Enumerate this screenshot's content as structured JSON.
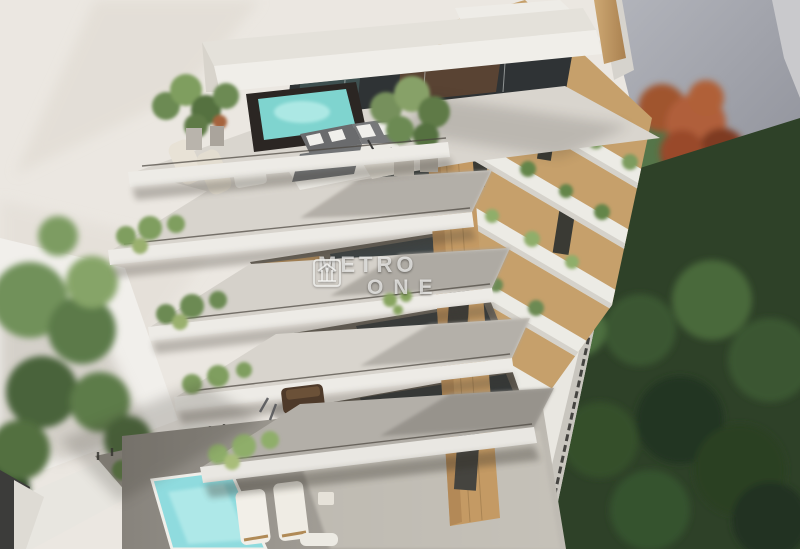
{
  "scene": {
    "type": "architectural-3d-render",
    "description": "Aerial visualization of a modern multi-storey residential building with rotated cantilevered terraces, rooftop jacuzzi terrace, garden pools and surrounding trees",
    "watermark": {
      "line1": "METRO",
      "line2": "ONE",
      "logo": "metro-one-logo"
    },
    "palette": {
      "background_cream": "#ebe7e1",
      "building_white": "#edebe6",
      "terrace_concrete": "#d8d4cd",
      "shadow_gray": "#8f8b84",
      "wood_panel": "#c49a64",
      "jacuzzi_water": "#7fd4cf",
      "pool_water": "#8fdbde",
      "plant_green": "#6c8a52",
      "garden_dark_green": "#2e4128",
      "red_tree": "#a0542f",
      "background_building_gray": "#a3a5ad"
    },
    "elements": {
      "rooftop": "roof terrace with plunge pool, lounge sofa and sun loungers",
      "terraces": "five zig-zag cantilevered terrace slabs with glass railings and planting",
      "ground": "garden with swimming pool, sun loungers and walkway canopy"
    }
  }
}
